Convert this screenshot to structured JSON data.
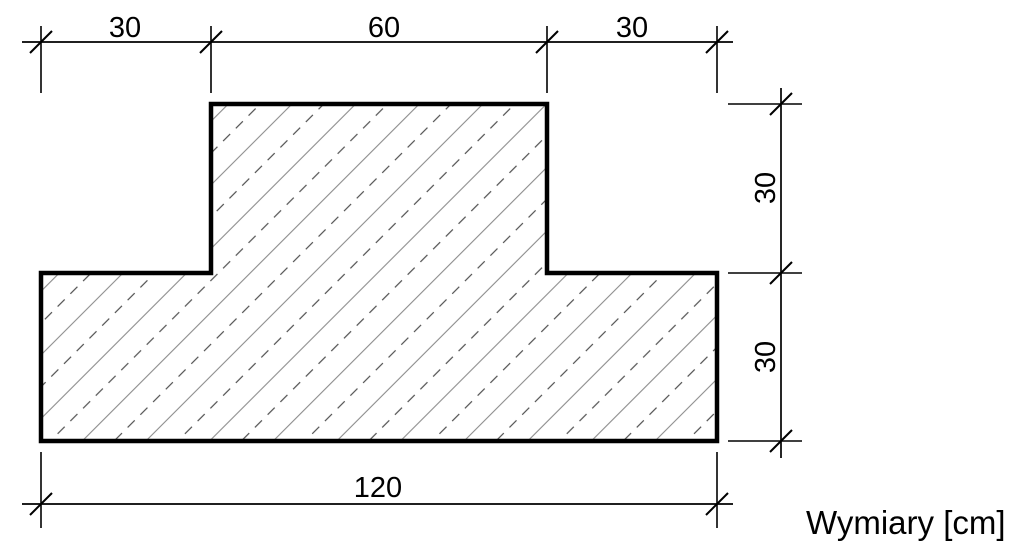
{
  "drawing": {
    "caption": "Wymiary [cm]",
    "units": "cm",
    "dimensions": {
      "top": [
        "30",
        "60",
        "30"
      ],
      "right": [
        "30",
        "30"
      ],
      "bottom": [
        "120"
      ]
    },
    "shape": {
      "kind": "T-section cross-section with diagonal hatch",
      "top_segments_cm": [
        30,
        60,
        30
      ],
      "right_segments_cm": [
        30,
        30
      ],
      "bottom_total_cm": 120
    },
    "colors": {
      "outline": "#000000",
      "dimension_lines": "#000000",
      "text": "#000000",
      "hatch_solid": "#8c8c8c",
      "hatch_dash": "#4f4f4f",
      "background": "#ffffff"
    }
  }
}
